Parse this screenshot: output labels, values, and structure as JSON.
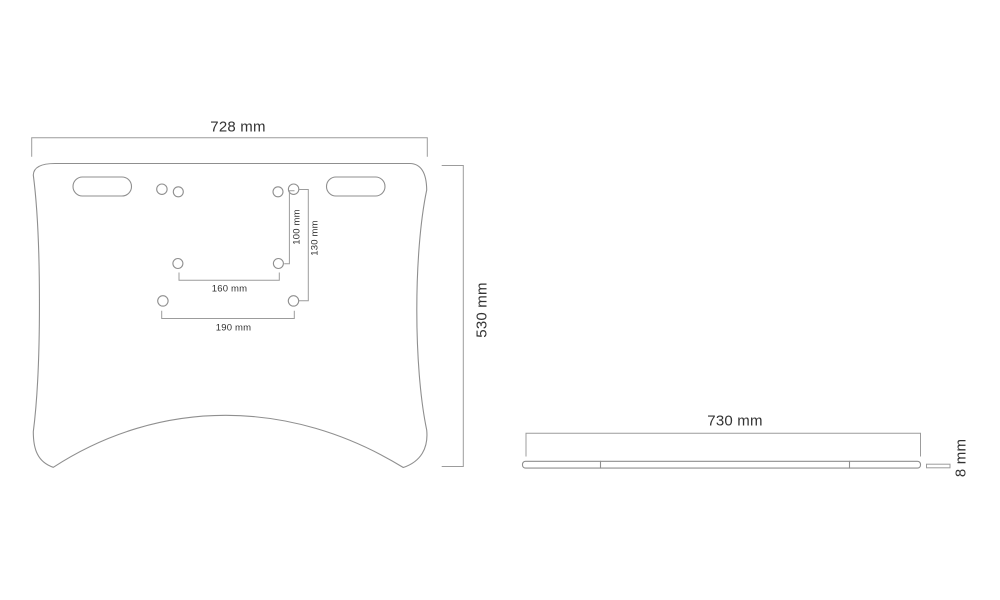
{
  "front_view": {
    "width_label": "728 mm",
    "height_label": "530 mm",
    "inner_vertical_label": "100 mm",
    "outer_vertical_label": "130 mm",
    "inner_horizontal_label": "160 mm",
    "outer_horizontal_label": "190 mm"
  },
  "side_view": {
    "width_label": "730 mm",
    "thickness_label": "8 mm"
  },
  "colors": {
    "outline": "#8f8f8f",
    "dimension_line": "#9c9c9c",
    "text": "#333333",
    "background": "#ffffff"
  }
}
